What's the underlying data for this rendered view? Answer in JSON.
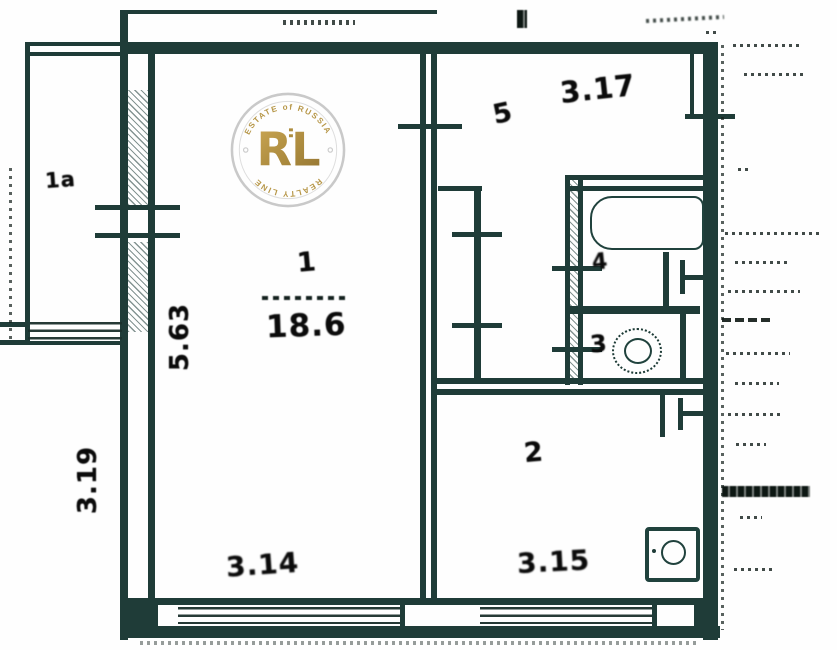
{
  "document": {
    "type": "scanned apartment floor plan"
  },
  "watermark": {
    "top_arc": "ESTATE of RUSSIA",
    "monogram": "RL",
    "bottom_arc": "REALTY LINE",
    "gold": "#b08d3e",
    "ring_color": "#c7c7c7"
  },
  "labels": {
    "room1": "1",
    "room1_area": "18.6",
    "room2": "2",
    "room3": "3",
    "room4": "4",
    "room5": "5",
    "balcony": "1a",
    "dim_top_right": "3.17",
    "dim_wall_left": "5.63",
    "dim_outer_left": "3.19",
    "dim_bottom_left": "3.14",
    "dim_bottom_right": "3.15"
  },
  "colors": {
    "wall": "#1f3c38",
    "paper": "#fefefe",
    "ink": "#0b0b0b"
  }
}
